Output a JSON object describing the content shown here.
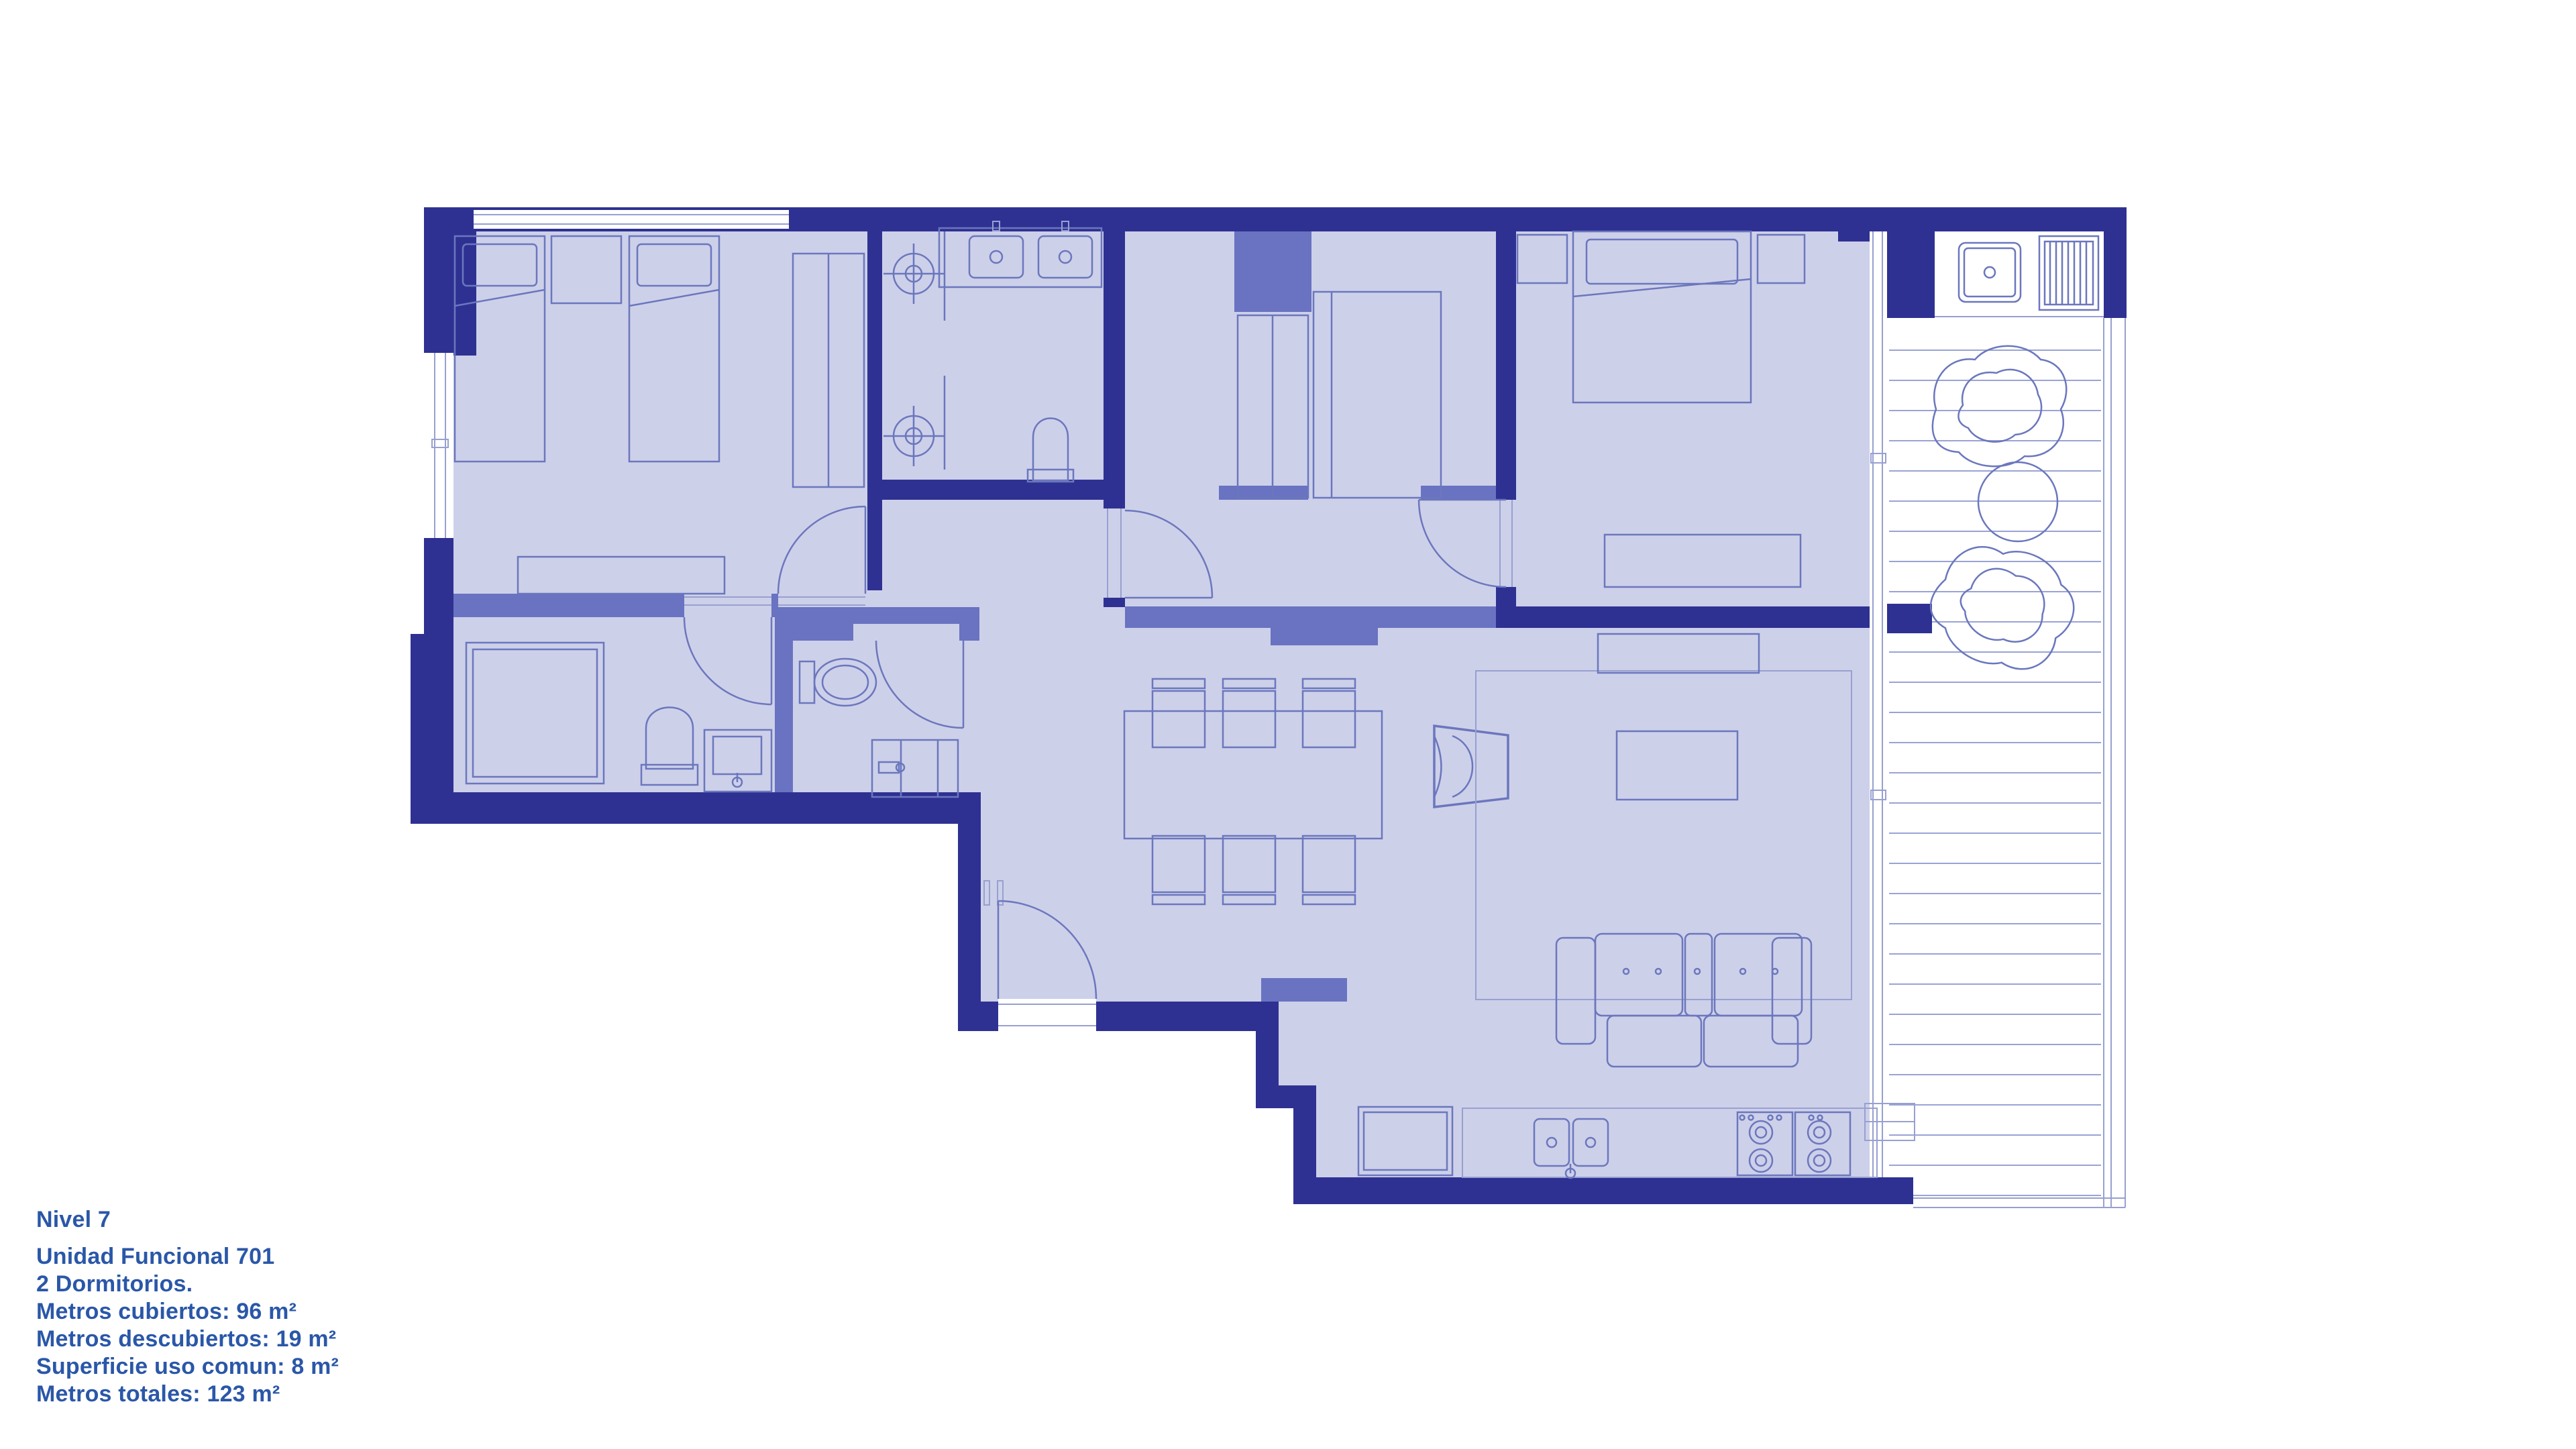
{
  "info_panel": {
    "level": "Nivel 7",
    "unit": "Unidad Funcional 701",
    "bedrooms": "2 Dormitorios.",
    "covered": "Metros cubiertos: 96 m²",
    "uncovered": "Metros descubiertos: 19 m²",
    "common": "Superficie uso comun: 8 m²",
    "total": "Metros totales: 123 m²"
  },
  "floor_plan": {
    "colors": {
      "wall_exterior": "#2e3192",
      "wall_interior": "#6973c1",
      "floor_covered": "#cdd0e9",
      "furniture_line": "#6b77bd",
      "light_line": "#97a0d0",
      "uncovered_floor": "#ffffff",
      "text": "#2a57a8"
    }
  }
}
